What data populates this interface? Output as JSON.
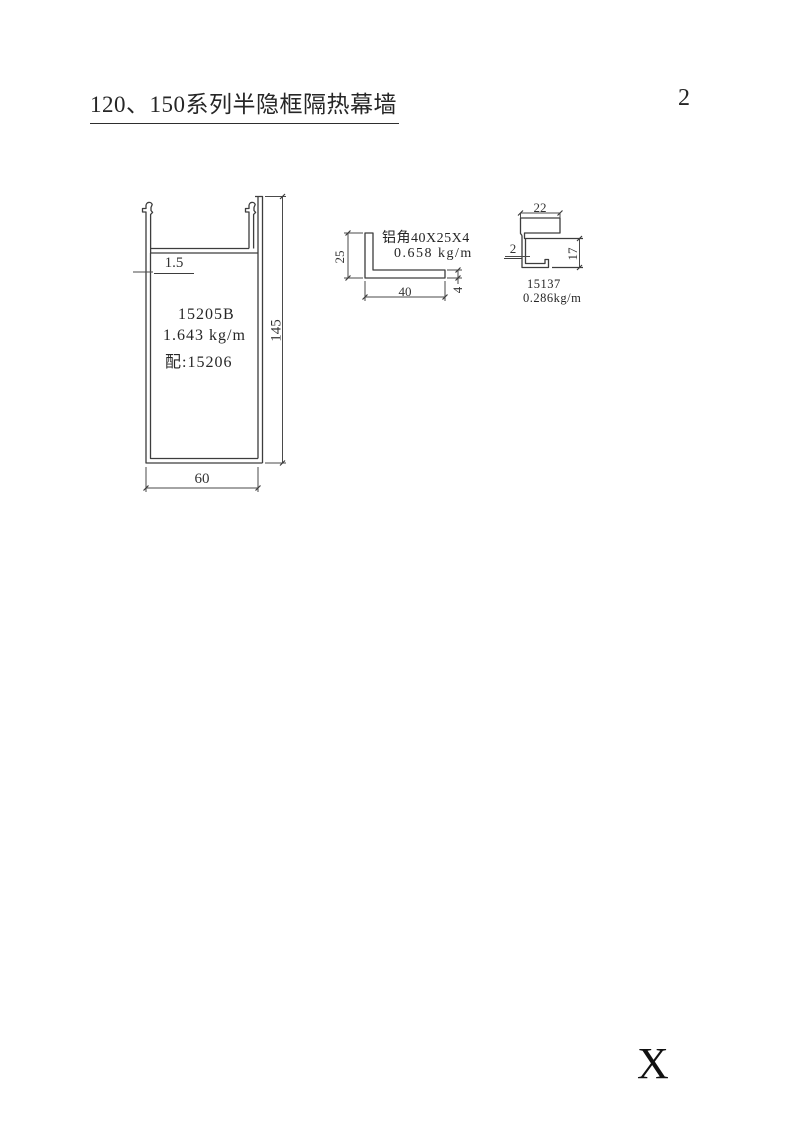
{
  "page": {
    "title": "120、150系列半隐框隔热幕墙",
    "page_number": "2",
    "footer_mark": "X"
  },
  "main_profile": {
    "model": "15205B",
    "weight": "1.643 kg/m",
    "match": "配:15206",
    "dim_thickness": "1.5",
    "dim_height": "145",
    "dim_width": "60"
  },
  "angle_profile": {
    "name": "铝角40X25X4",
    "weight": "0.658 kg/m",
    "dim_leg": "25",
    "dim_base": "40",
    "dim_thickness": "4"
  },
  "channel_profile": {
    "model": "15137",
    "weight": "0.286kg/m",
    "dim_width": "22",
    "dim_thickness": "2",
    "dim_height": "17"
  },
  "colors": {
    "line": "#3d3d3d",
    "dim_line": "#4a4a4a",
    "text": "#262626",
    "background": "#ffffff"
  }
}
